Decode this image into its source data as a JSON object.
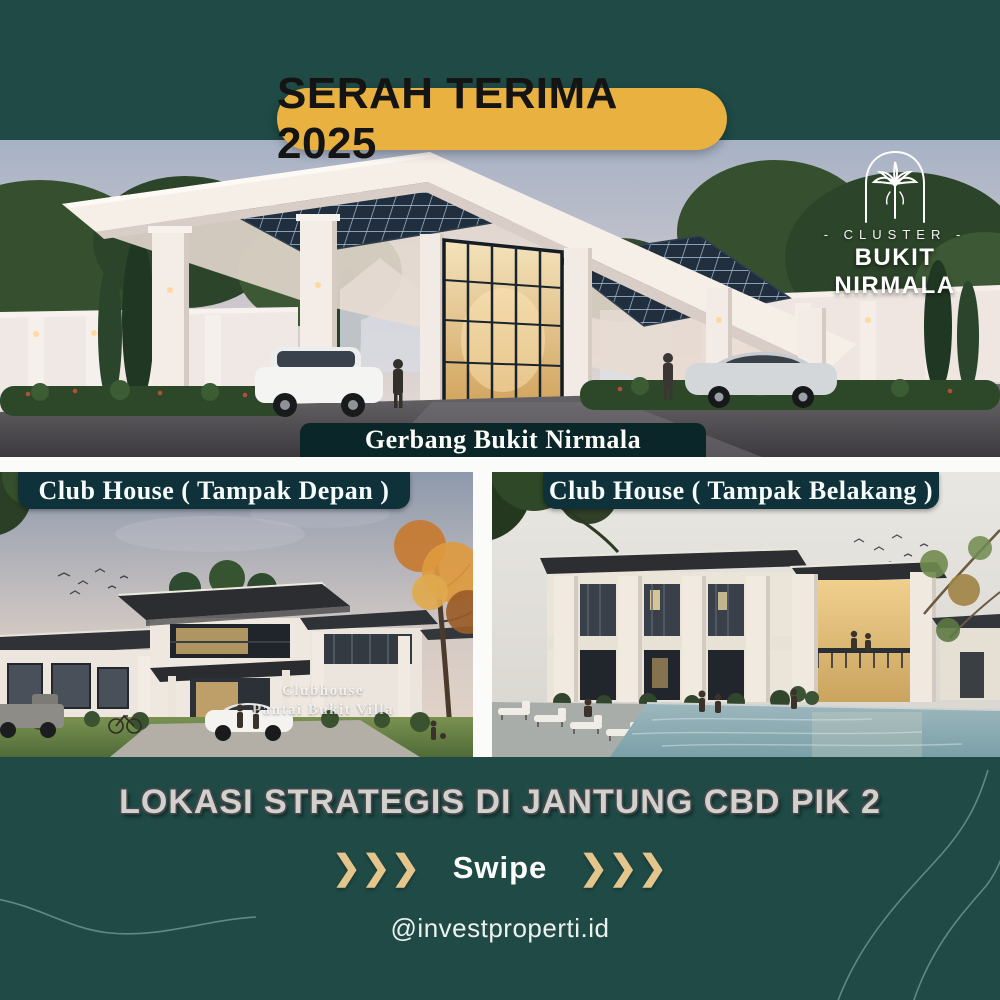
{
  "badge": {
    "label": "SERAH TERIMA 2025"
  },
  "logo": {
    "cluster": "- CLUSTER -",
    "name": "BUKIT NIRMALA"
  },
  "gate": {
    "caption": "Gerbang Bukit Nirmala"
  },
  "clubhouse_front": {
    "label": "Club House ( Tampak Depan )",
    "watermark_line1": "Clubhouse",
    "watermark_line2": "Pantai Bukit Villa"
  },
  "clubhouse_back": {
    "label": "Club House ( Tampak Belakang )"
  },
  "headline": {
    "text": "LOKASI STRATEGIS DI JANTUNG CBD PIK 2"
  },
  "swipe": {
    "label": "Swipe",
    "chevrons": "❯❯❯"
  },
  "footer": {
    "handle": "@investproperti.id"
  },
  "colors": {
    "background": "#1f4a46",
    "badge_fill": "#e9b140",
    "badge_text": "#141414",
    "caption_bar": "#0a2628",
    "label_bar": "#0f313a",
    "gold_accent": "#e4c58c",
    "headline_text": "#d3d1ce",
    "white_band": "#fbfbfa"
  }
}
